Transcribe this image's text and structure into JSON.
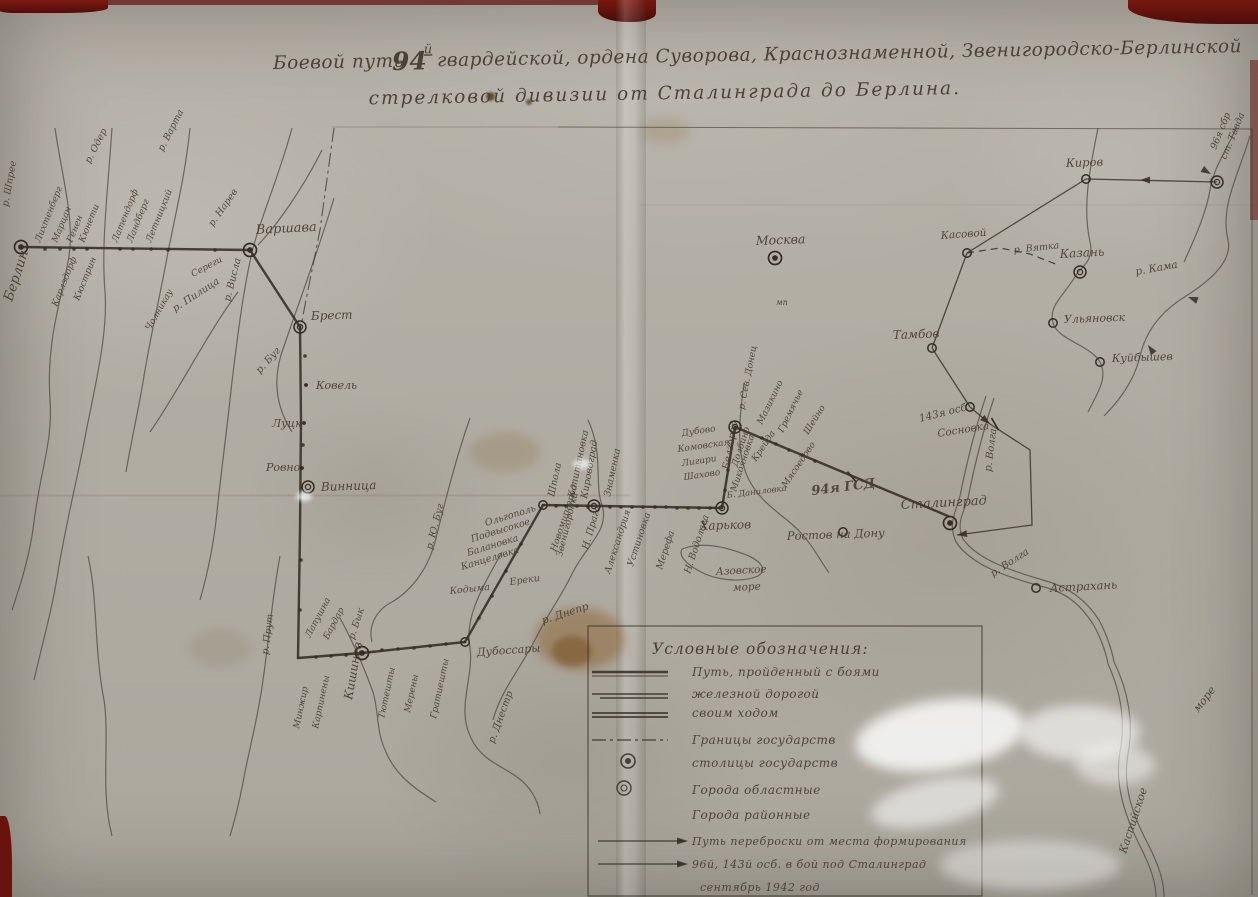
{
  "title": {
    "line1_pre": "Боевой путь ",
    "line1_num": "94",
    "line1_sup": "й",
    "line1_post": " гвардейской, ордена Суворова, Краснознаменной, Звенигородско-Берлинской",
    "line2": "стрелковой дивизии от Сталинграда до Берлина."
  },
  "legend": {
    "box": {
      "x": 588,
      "y": 626,
      "w": 394,
      "h": 270
    },
    "title": "Условные обозначения:",
    "items": [
      {
        "sym": "battle",
        "label": "Путь, пройденный с боями"
      },
      {
        "sym": "rail",
        "label": "железной дорогой"
      },
      {
        "sym": "double",
        "label": "своим ходом"
      },
      {
        "sym": "dashdot",
        "label": "Границы государств"
      },
      {
        "sym": "capital",
        "label": "столицы государств"
      },
      {
        "sym": "oblast",
        "label": "Города областные"
      },
      {
        "sym": "none",
        "label": "Города районные"
      },
      {
        "sym": "arrow",
        "label": "Путь переброски от места формирования"
      },
      {
        "sym": "arrow",
        "label": "96й, 143й осб. в бой под Сталинград"
      },
      {
        "sym": "none",
        "label": "сентябрь 1942 год"
      }
    ]
  },
  "map": {
    "ink": "#332d24",
    "routes": [
      [
        [
          21,
          247
        ],
        [
          250,
          250
        ]
      ],
      [
        [
          250,
          250
        ],
        [
          300,
          327
        ]
      ],
      [
        [
          300,
          327
        ],
        [
          301,
          420
        ],
        [
          300,
          530
        ],
        [
          298,
          658
        ]
      ],
      [
        [
          298,
          658
        ],
        [
          362,
          653
        ]
      ],
      [
        [
          362,
          653
        ],
        [
          465,
          642
        ]
      ],
      [
        [
          465,
          642
        ],
        [
          543,
          505
        ]
      ],
      [
        [
          543,
          505
        ],
        [
          722,
          508
        ]
      ],
      [
        [
          722,
          508
        ],
        [
          735,
          427
        ]
      ],
      [
        [
          735,
          427
        ],
        [
          948,
          516
        ]
      ]
    ],
    "transfer": [
      {
        "p": [
          [
            1217,
            182
          ],
          [
            1086,
            179
          ]
        ]
      },
      {
        "p": [
          [
            1086,
            179
          ],
          [
            967,
            253
          ]
        ]
      },
      {
        "p": [
          [
            967,
            253
          ],
          [
            932,
            348
          ]
        ]
      },
      {
        "p": [
          [
            932,
            348
          ],
          [
            970,
            407
          ]
        ]
      },
      {
        "p": [
          [
            970,
            407
          ],
          [
            990,
            424
          ]
        ]
      },
      {
        "p": [
          [
            990,
            424
          ],
          [
            1030,
            450
          ],
          [
            1032,
            525
          ],
          [
            957,
            535
          ]
        ]
      },
      {
        "p": [
          [
            967,
            253
          ],
          [
            1000,
            248
          ],
          [
            1030,
            254
          ],
          [
            1058,
            265
          ]
        ],
        "dash": true
      }
    ],
    "borders": [
      [
        [
          334,
          128
        ],
        [
          320,
          230
        ],
        [
          306,
          300
        ],
        [
          301,
          326
        ]
      ]
    ],
    "rivers": [
      "M55,128 C62,178 76,222 68,262 C61,300 46,342 50,400 C53,442 40,472 34,522 C30,556 20,586 12,610",
      "M112,128 C108,190 101,242 105,292 C108,332 96,382 86,432 C79,472 66,522 58,572 C52,610 42,645 34,680",
      "M190,128 C186,170 176,212 168,252 C161,292 151,332 143,382 C138,412 131,442 126,472",
      "M292,128 C281,170 263,212 253,248 C243,290 237,340 231,390 C227,430 221,472 217,512 C214,542 208,572 200,600",
      "M150,432 C178,392 208,332 238,292",
      "M322,150 C302,190 277,225 258,245",
      "M334,198 C316,258 296,310 281,355 C272,386 279,412 292,432",
      "M470,418 C456,458 446,498 436,538 C429,568 412,590 392,602 C376,610 368,626 372,642",
      "M502,552 C482,588 464,618 470,648 C474,678 456,708 471,738 C481,760 502,766 517,777 C530,786 538,800 540,814",
      "M340,618 C352,640 362,662 373,692 C379,712 376,732 386,752 C396,777 420,792 436,802",
      "M280,556 C272,598 269,640 263,680 C259,712 251,742 245,772 C241,794 236,816 230,836",
      "M88,556 C98,600 94,650 104,700 C110,740 100,790 112,836",
      "M588,420 C604,454 594,484 602,505 C610,530 586,546 573,572 C561,597 549,612 537,636 C521,668 501,690 493,720",
      "M744,383 C739,420 736,452 748,478 C761,505 786,516 801,533 C813,546 820,560 829,573",
      "M682,549 C700,542 722,546 741,553 C759,559 769,569 758,576 C739,584 713,579 699,571 C687,564 678,556 682,549",
      "M1098,128 C1090,168 1082,206 1090,242 C1094,258 1084,266 1078,272",
      "M1236,128 C1226,152 1214,166 1210,190 C1206,214 1194,240 1184,262",
      "M1250,136 C1238,176 1220,206 1228,240 C1233,262 1208,282 1186,296 C1163,310 1146,330 1140,356 C1134,382 1118,402 1104,416",
      "M1078,272 C1065,295 1048,305 1053,323 C1058,340 1090,345 1100,362 C1108,378 1098,392 1088,412",
      "M986,396 C974,432 966,466 960,496 C955,514 948,524 956,542 C972,566 1008,577 1040,586 C1066,592 1080,604 1093,624 C1100,636 1106,652 1108,664",
      "M994,398 C982,434 974,468 968,498 C963,514 956,524 963,539 C978,560 1012,571 1043,580 C1069,587 1086,600 1099,620 C1106,633 1112,650 1114,662",
      "M1108,664 C1120,690 1126,720 1120,752 C1114,786 1126,818 1140,846 C1150,866 1156,882 1156,897",
      "M1114,662 C1128,690 1134,722 1128,754 C1122,788 1134,818 1148,844 C1158,864 1164,880 1164,897"
    ],
    "cities": [
      {
        "name": "Берлин",
        "x": 21,
        "y": 247,
        "sym": "capital",
        "lx": 12,
        "ly": 302,
        "r": -72,
        "s": 13.5
      },
      {
        "name": "Варшава",
        "x": 250,
        "y": 250,
        "sym": "capital",
        "lx": 256,
        "ly": 234,
        "r": -3,
        "s": 13
      },
      {
        "name": "Москва",
        "x": 775,
        "y": 258,
        "sym": "capital",
        "lx": 756,
        "ly": 245,
        "r": -2,
        "s": 12.5
      },
      {
        "name": "Брест",
        "x": 300,
        "y": 327,
        "sym": "oblast",
        "lx": 311,
        "ly": 320,
        "r": -2,
        "s": 12
      },
      {
        "name": "Винница",
        "x": 308,
        "y": 487,
        "sym": "oblast",
        "lx": 321,
        "ly": 491,
        "r": -2,
        "s": 12
      },
      {
        "name": "Кишинев",
        "x": 362,
        "y": 653,
        "sym": "capital",
        "lx": 352,
        "ly": 700,
        "r": -80,
        "s": 12
      },
      {
        "name": "Дубоссары",
        "x": 465,
        "y": 642,
        "sym": "district",
        "lx": 477,
        "ly": 656,
        "r": -4,
        "s": 11
      },
      {
        "name": "",
        "x": 543,
        "y": 505,
        "sym": "district",
        "lx": 0,
        "ly": 0,
        "r": 0,
        "s": 0
      },
      {
        "name": "Кировоград",
        "x": 594,
        "y": 506,
        "sym": "oblast",
        "lx": 587,
        "ly": 499,
        "r": -80,
        "s": 9.5
      },
      {
        "name": "Харьков",
        "x": 722,
        "y": 508,
        "sym": "oblast",
        "lx": 700,
        "ly": 530,
        "r": -2,
        "s": 12
      },
      {
        "name": "Белгород",
        "x": 735,
        "y": 427,
        "sym": "oblast",
        "lx": 729,
        "ly": 470,
        "r": -80,
        "s": 10
      },
      {
        "name": "Сталинград",
        "x": 950,
        "y": 523,
        "sym": "capital",
        "lx": 901,
        "ly": 509,
        "r": -3,
        "s": 13
      },
      {
        "name": "Ростов на Дону",
        "x": 843,
        "y": 532,
        "sym": "district",
        "lx": 787,
        "ly": 540,
        "r": -2,
        "s": 11.5
      },
      {
        "name": "Астрахань",
        "x": 1036,
        "y": 588,
        "sym": "district",
        "lx": 1050,
        "ly": 592,
        "r": -3,
        "s": 11.5
      },
      {
        "name": "Киров",
        "x": 1086,
        "y": 179,
        "sym": "district",
        "lx": 1066,
        "ly": 167,
        "r": -2,
        "s": 11.5
      },
      {
        "name": "Касовой",
        "x": 967,
        "y": 253,
        "sym": "district",
        "lx": 941,
        "ly": 239,
        "r": -4,
        "s": 10.5
      },
      {
        "name": "Казань",
        "x": 1080,
        "y": 272,
        "sym": "oblast",
        "lx": 1060,
        "ly": 258,
        "r": -3,
        "s": 12
      },
      {
        "name": "Ульяновск",
        "x": 1053,
        "y": 323,
        "sym": "district",
        "lx": 1064,
        "ly": 323,
        "r": -2,
        "s": 11
      },
      {
        "name": "Куйбышев",
        "x": 1100,
        "y": 362,
        "sym": "district",
        "lx": 1112,
        "ly": 362,
        "r": -2,
        "s": 11
      },
      {
        "name": "Тамбов",
        "x": 932,
        "y": 348,
        "sym": "district",
        "lx": 893,
        "ly": 339,
        "r": -2,
        "s": 12
      },
      {
        "name": "",
        "x": 1217,
        "y": 182,
        "sym": "oblast",
        "lx": 0,
        "ly": 0,
        "r": 0,
        "s": 0
      },
      {
        "name": "",
        "x": 970,
        "y": 407,
        "sym": "district",
        "lx": 0,
        "ly": 0,
        "r": 0,
        "s": 0
      },
      {
        "name": "Ковель",
        "x": 306,
        "y": 385,
        "sym": "dot",
        "lx": 316,
        "ly": 389,
        "r": 0,
        "s": 11
      },
      {
        "name": "Луцк",
        "x": 304,
        "y": 423,
        "sym": "dot",
        "lx": 272,
        "ly": 427,
        "r": 0,
        "s": 11
      },
      {
        "name": "Ровно",
        "x": 302,
        "y": 468,
        "sym": "dot",
        "lx": 266,
        "ly": 471,
        "r": 0,
        "s": 11
      }
    ],
    "dots": [
      45,
      249,
      60,
      249,
      74,
      249,
      87,
      249,
      120,
      249,
      133,
      249,
      151,
      249,
      168,
      250,
      215,
      250,
      556,
      506,
      566,
      506,
      577,
      506,
      588,
      507,
      610,
      507,
      621,
      507,
      632,
      507,
      643,
      507,
      655,
      507,
      666,
      507,
      677,
      508,
      688,
      508,
      699,
      508,
      710,
      508,
      762,
      438,
      776,
      444,
      789,
      450,
      802,
      455,
      815,
      461,
      728,
      470,
      725,
      490,
      521,
      544,
      506,
      571,
      492,
      596,
      479,
      618,
      382,
      650,
      398,
      649,
      414,
      648,
      430,
      646,
      446,
      644,
      316,
      657,
      331,
      656,
      346,
      655,
      305,
      356,
      303,
      445,
      301,
      560,
      300,
      610
    ],
    "ticks": [
      {
        "x": 852,
        "y": 477,
        "r": 50
      },
      {
        "x": 995,
        "y": 424,
        "r": 60
      }
    ],
    "arrows": [
      {
        "x": 1140,
        "y": 180,
        "a": 180
      },
      {
        "x": 990,
        "y": 424,
        "a": 40
      },
      {
        "x": 957,
        "y": 535,
        "a": 172
      },
      {
        "x": 1188,
        "y": 297,
        "a": 200
      },
      {
        "x": 1148,
        "y": 345,
        "a": 235
      },
      {
        "x": 1211,
        "y": 174,
        "a": 30
      }
    ],
    "labels": [
      [
        "р. Шпрее",
        8,
        207,
        -80,
        9.5
      ],
      [
        "р. Одер",
        90,
        164,
        -63,
        9.5
      ],
      [
        "р. Варта",
        163,
        152,
        -63,
        9.5
      ],
      [
        "Лихтенберг",
        40,
        243,
        -68,
        9
      ],
      [
        "Марцан",
        57,
        243,
        -68,
        9
      ],
      [
        "Генен",
        72,
        243,
        -68,
        9
      ],
      [
        "Кюнети",
        84,
        243,
        -68,
        9
      ],
      [
        "Карлздорф",
        57,
        307,
        -68,
        9
      ],
      [
        "Кюстрин",
        79,
        301,
        -68,
        9
      ],
      [
        "Латендорф",
        117,
        243,
        -68,
        9
      ],
      [
        "Ландберг",
        132,
        243,
        -68,
        9
      ],
      [
        "Летницкий",
        151,
        243,
        -68,
        9
      ],
      [
        "Чолникау",
        150,
        331,
        -60,
        9
      ],
      [
        "Сереги",
        193,
        277,
        -28,
        9
      ],
      [
        "р. Пилица",
        175,
        312,
        -33,
        10
      ],
      [
        "р. Висла",
        230,
        302,
        -76,
        10
      ],
      [
        "р. Нарев",
        213,
        227,
        -55,
        9.5
      ],
      [
        "р. Буг",
        260,
        374,
        -48,
        10
      ],
      [
        "р. Прут",
        268,
        655,
        -83,
        9.5
      ],
      [
        "р. Бык",
        354,
        640,
        -72,
        9.5
      ],
      [
        "Лапушна",
        310,
        638,
        -62,
        9
      ],
      [
        "Бардар",
        328,
        640,
        -62,
        9
      ],
      [
        "Минжир",
        299,
        729,
        -78,
        9
      ],
      [
        "Карпинены",
        318,
        729,
        -78,
        9
      ],
      [
        "Тютешты",
        384,
        719,
        -78,
        9
      ],
      [
        "Мерены",
        410,
        713,
        -78,
        9
      ],
      [
        "Гратиешты",
        436,
        719,
        -78,
        9
      ],
      [
        "р. Днестр",
        494,
        744,
        -70,
        10
      ],
      [
        "Кодыма",
        450,
        594,
        -6,
        9.5
      ],
      [
        "Ереки",
        510,
        585,
        -8,
        9.5
      ],
      [
        "Ольгополь",
        486,
        526,
        -17,
        9.5
      ],
      [
        "Подвысокое",
        472,
        542,
        -17,
        9.5
      ],
      [
        "Балановка",
        468,
        556,
        -17,
        9.5
      ],
      [
        "Канцеловка",
        462,
        570,
        -17,
        9.5
      ],
      [
        "р. Ю. Буг",
        432,
        550,
        -76,
        9.5
      ],
      [
        "Звенигородка",
        562,
        557,
        -76,
        9
      ],
      [
        "Шпола",
        554,
        497,
        -78,
        9.5
      ],
      [
        "Капитановка",
        574,
        498,
        -78,
        9.5
      ],
      [
        "Знаменка",
        610,
        497,
        -78,
        9.5
      ],
      [
        "Новомиргород",
        556,
        552,
        -72,
        9
      ],
      [
        "Н. Прага",
        588,
        550,
        -74,
        9.5
      ],
      [
        "Александрия",
        610,
        574,
        -72,
        9.5
      ],
      [
        "Устиновка",
        633,
        567,
        -72,
        9.5
      ],
      [
        "Мерефа",
        662,
        570,
        -72,
        9.5
      ],
      [
        "Н. Водолага",
        690,
        574,
        -72,
        9.5
      ],
      [
        "Дубово",
        682,
        436,
        -8,
        9
      ],
      [
        "Комовская",
        678,
        452,
        -8,
        9
      ],
      [
        "Лигири",
        682,
        466,
        -8,
        9
      ],
      [
        "Шахово",
        684,
        480,
        -8,
        9
      ],
      [
        "р. Днепр",
        543,
        624,
        -18,
        10.5
      ],
      [
        "Азовское",
        716,
        575,
        -3,
        10.5
      ],
      [
        "море",
        733,
        591,
        -3,
        10.5
      ],
      [
        "р. Сев. Донец",
        744,
        410,
        -79,
        9
      ],
      [
        "Мазикино",
        762,
        425,
        -64,
        9
      ],
      [
        "Гремячье",
        783,
        433,
        -64,
        9
      ],
      [
        "Шейно",
        808,
        435,
        -58,
        9
      ],
      [
        "Крейда",
        756,
        462,
        -56,
        9
      ],
      [
        "Мясоедово",
        786,
        488,
        -56,
        9
      ],
      [
        "Долбино",
        737,
        467,
        -72,
        9
      ],
      [
        "Микояновка",
        736,
        492,
        -72,
        9
      ],
      [
        "Б. Даниловка",
        727,
        498,
        -7,
        8.5
      ],
      [
        "94я ГСД",
        812,
        495,
        -7,
        13,
        1
      ],
      [
        "143я осб",
        920,
        422,
        -14,
        10.5
      ],
      [
        "Сосновка",
        938,
        437,
        -9,
        10.5
      ],
      [
        "р. Волга",
        991,
        472,
        -83,
        10
      ],
      [
        "р. Волга",
        993,
        577,
        -33,
        10
      ],
      [
        "Каспийское",
        1126,
        854,
        -72,
        11
      ],
      [
        "море",
        1198,
        713,
        -52,
        11
      ],
      [
        "р. Кама",
        1136,
        275,
        -10,
        10.5
      ],
      [
        "р. Вятка",
        1014,
        253,
        -6,
        9.5
      ],
      [
        "96я сбр",
        1216,
        150,
        -68,
        9.5
      ],
      [
        "ст. Тавда",
        1226,
        160,
        -68,
        9.5
      ],
      [
        "мп",
        776,
        305,
        0,
        8
      ]
    ]
  }
}
